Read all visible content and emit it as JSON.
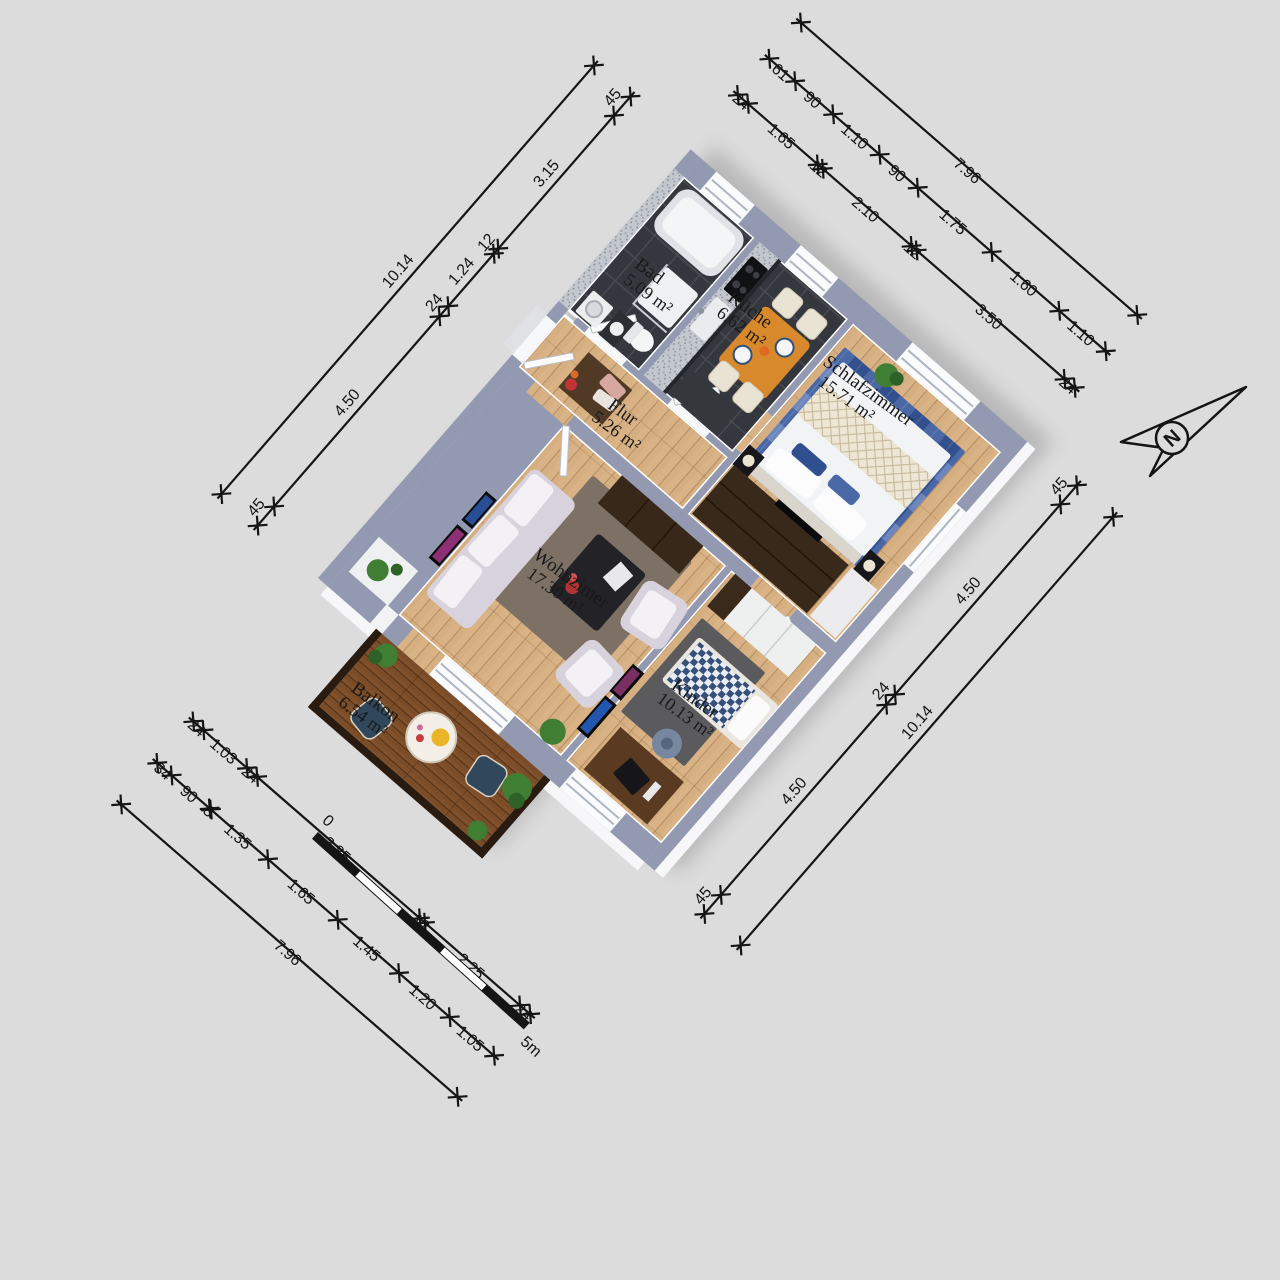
{
  "rooms": {
    "bad": {
      "name": "Bad",
      "area": "5.09 m²"
    },
    "kueche": {
      "name": "Küche",
      "area": "6.62 m²"
    },
    "schlafzimmer": {
      "name": "Schlafzimmer",
      "area": "15.71 m²"
    },
    "flur": {
      "name": "Flur",
      "area": "5.26 m²"
    },
    "wohnzimmer": {
      "name": "Wohnzimer",
      "area": "17.30 m²"
    },
    "kinder": {
      "name": "Kinder",
      "area": "10.13 m²"
    },
    "balkon": {
      "name": "Balkon",
      "area": "6.54 m²"
    }
  },
  "dimensions": {
    "nw_inner": [
      "45",
      "4.50",
      "24",
      "1.24",
      "12",
      "3.15",
      "45"
    ],
    "nw_outer": [
      "10.14"
    ],
    "ne_inner": [
      "24",
      "1.65",
      "12",
      "2.10",
      "12",
      "3.50",
      "24"
    ],
    "ne_mid": [
      "61",
      "90",
      "1.10",
      "90",
      "1.75",
      "1.60",
      "1.10"
    ],
    "ne_outer": [
      "7.96"
    ],
    "se_inner": [
      "45",
      "4.50",
      "24",
      "4.50",
      "45"
    ],
    "se_outer": [
      "10.14"
    ],
    "sw_inner": [
      "24",
      "1.03",
      "24",
      "3.85",
      "12",
      "2.25",
      "24"
    ],
    "sw_mid": [
      "34",
      "90",
      "3",
      "1.35",
      "1.65",
      "1.45",
      "1.20",
      "1.05"
    ],
    "sw_outer": [
      "7.96"
    ]
  },
  "scale_bar": {
    "start": "0",
    "end": "5m"
  },
  "compass": {
    "label": "N"
  },
  "colors": {
    "background": "#dcdcdc",
    "wall_top": "#9299b1",
    "wood_floor": "#d9b286",
    "dark_tile": "#34373d",
    "deck": "#7b4c28",
    "ink": "#151515"
  }
}
